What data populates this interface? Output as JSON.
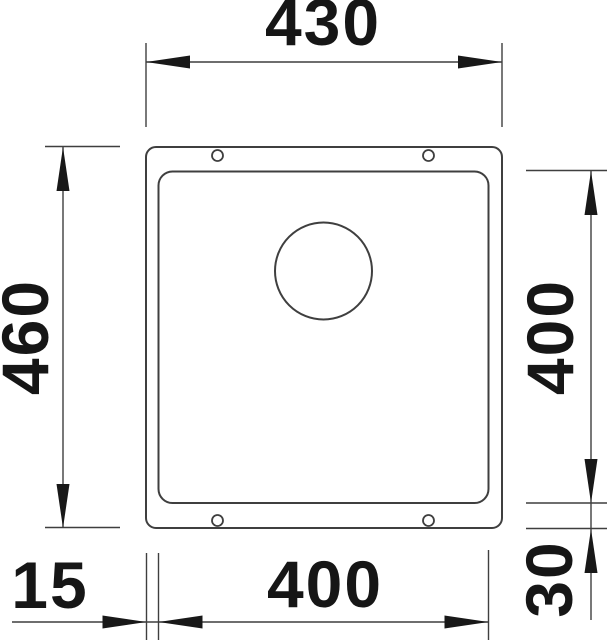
{
  "drawing": {
    "type": "technical-dimension-drawing",
    "subject": "undermount-sink-top-view",
    "dimension_labels": {
      "top_width": "430",
      "left_height": "460",
      "right_height": "400",
      "bottom_width": "400",
      "bottom_left_offset": "15",
      "bottom_right_offset": "30"
    },
    "colors": {
      "background": "#ffffff",
      "line": "#3f3f3f",
      "text": "#161616",
      "arrow": "#181818"
    }
  }
}
